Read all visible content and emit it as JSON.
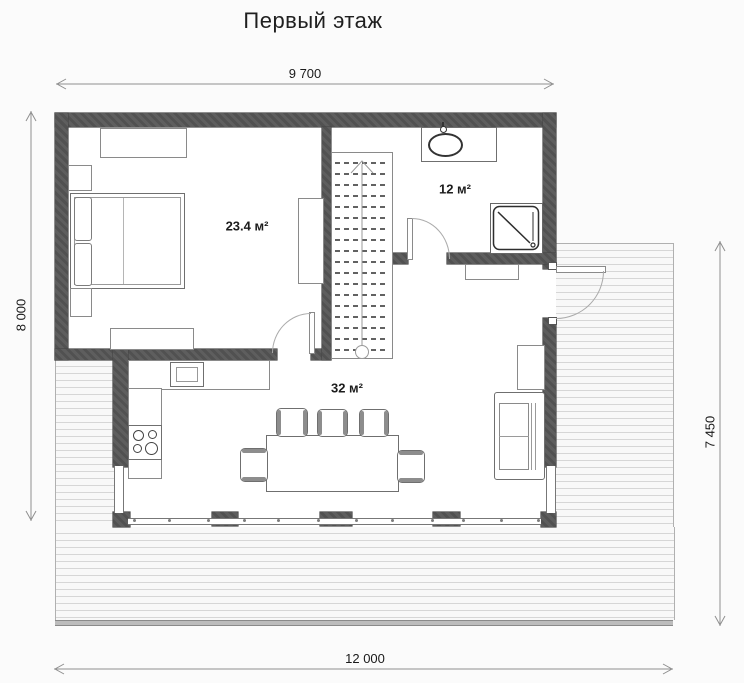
{
  "title": "Первый этаж",
  "dimensions": {
    "top": "9 700",
    "left": "8 000",
    "right": "7 450",
    "terrace_bottom": "8 500",
    "overall_bottom": "12 000"
  },
  "rooms": {
    "bedroom": {
      "area_label": "23.4 м²"
    },
    "bathroom": {
      "area_label": "12 м²"
    },
    "living_kitchen": {
      "area_label": "32 м²"
    }
  },
  "colors": {
    "wall": "#565656",
    "dimension_line": "#8f8f8f",
    "deck_plank": "#d6d6d6",
    "furniture_outline": "#8a8a8a"
  }
}
